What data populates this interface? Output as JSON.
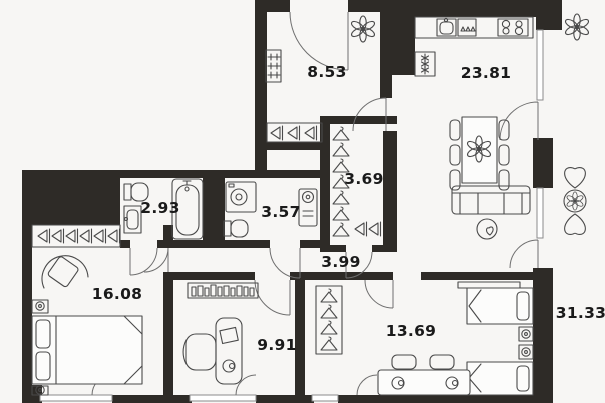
{
  "colors": {
    "background": "#f7f6f4",
    "wall": "#2e2b27",
    "label": "#1a1a1a",
    "furniture_line": "#4a4a4a",
    "door_line": "#6f6f6f"
  },
  "rooms": [
    {
      "id": "hall",
      "area": "8.53"
    },
    {
      "id": "kitchen-living",
      "area": "23.81"
    },
    {
      "id": "wardrobe",
      "area": "3.69"
    },
    {
      "id": "bathroom",
      "area": "2.93"
    },
    {
      "id": "shower-room",
      "area": "3.57"
    },
    {
      "id": "corridor",
      "area": "3.99"
    },
    {
      "id": "bedroom",
      "area": "16.08"
    },
    {
      "id": "study",
      "area": "9.91"
    },
    {
      "id": "kids-room",
      "area": "13.69"
    },
    {
      "id": "total-right",
      "area": "31.33"
    }
  ]
}
